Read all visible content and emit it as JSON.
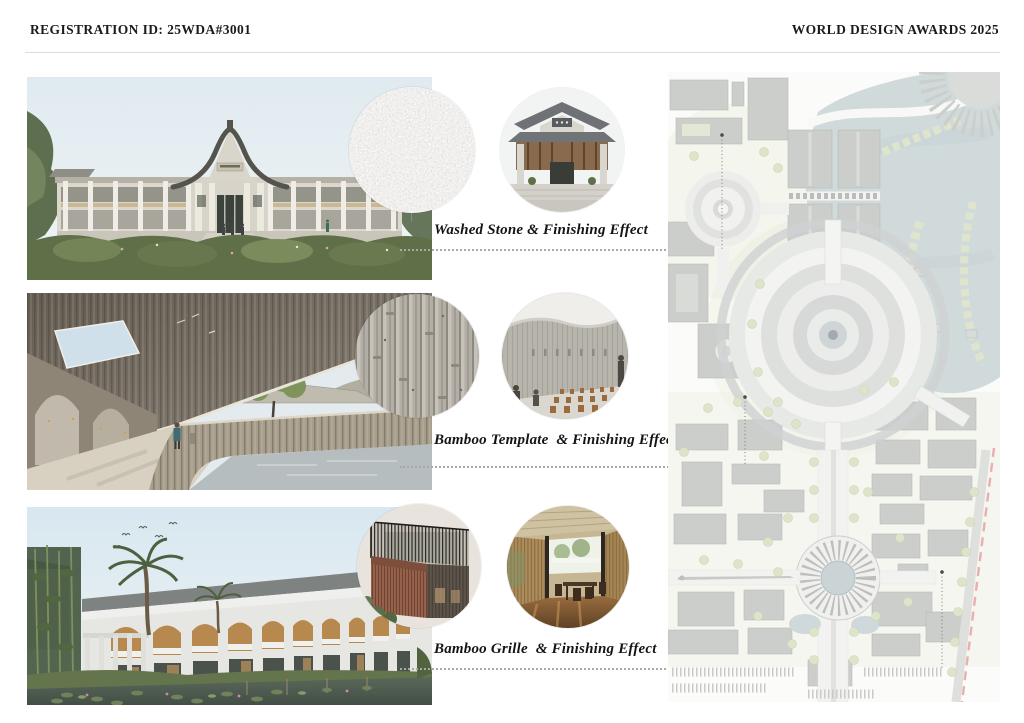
{
  "header": {
    "registration_id": "REGISTRATION ID: 25WDA#3001",
    "awards_title": "WORLD DESIGN AWARDS 2025",
    "divider_color": "#dcdcdc",
    "text_color": "#1b1b1b"
  },
  "gallery": {
    "renderings": [
      {
        "name": "main-hall-exterior-rendering"
      },
      {
        "name": "concrete-arcade-rendering"
      },
      {
        "name": "courtyard-pond-rendering"
      }
    ]
  },
  "annotations": [
    {
      "caption": "Washed Stone & Finishing Effect",
      "texture_icon": "washed-stone-texture",
      "reference_icon": "temple-facade-photo"
    },
    {
      "caption": "Bamboo Template  & Finishing Effect",
      "texture_icon": "bamboo-formwork-concrete-texture",
      "reference_icon": "concrete-hall-interior-photo"
    },
    {
      "caption": "Bamboo Grille  & Finishing Effect",
      "texture_icon": "bamboo-grille-texture",
      "reference_icon": "bamboo-interior-photo"
    }
  ],
  "master_plan": {
    "name": "site-master-plan"
  },
  "colors": {
    "caption_text": "#141414",
    "leader_dotted": "#a9a9a9",
    "plan_water": "#cdd8d9",
    "plan_building": "#c9cbc9",
    "plan_green": "#dde4c9",
    "plan_boundary_dashed": "#e59c9c"
  }
}
